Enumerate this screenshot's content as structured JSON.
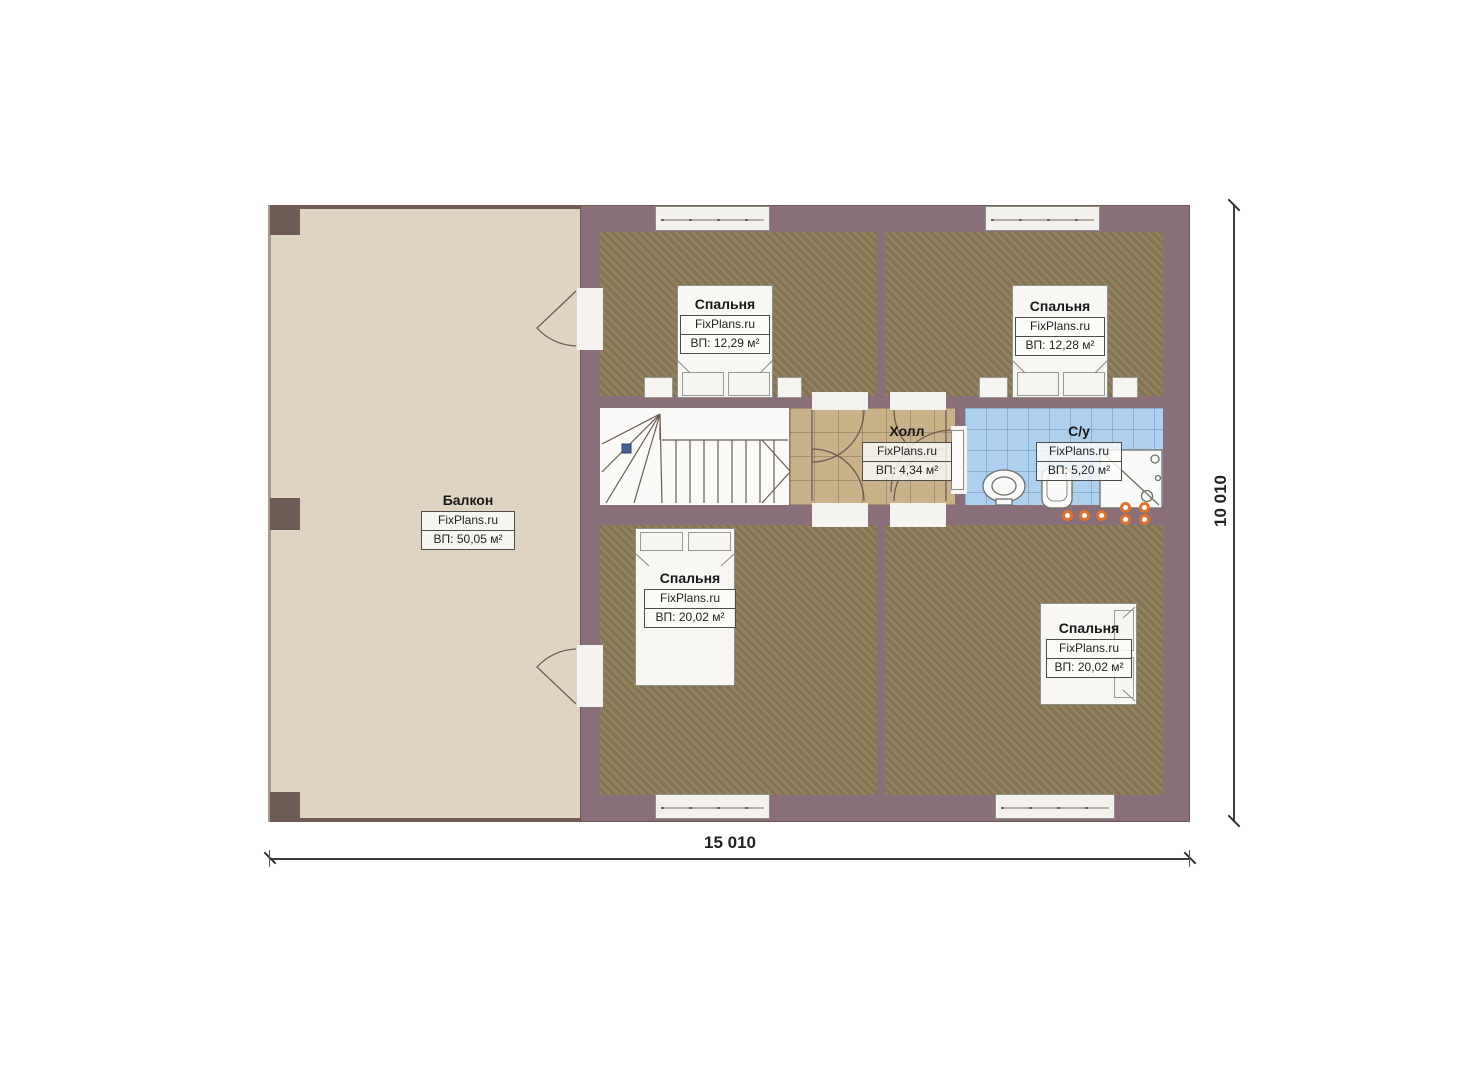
{
  "plan": {
    "watermark": "FixPlans.ru",
    "dimensions": {
      "width": "15 010",
      "height": "10 010"
    },
    "rooms": {
      "balcony": {
        "name": "Балкон",
        "area": "ВП: 50,05 м²"
      },
      "bedroom_tl": {
        "name": "Спальня",
        "area": "ВП: 12,29 м²"
      },
      "bedroom_tr": {
        "name": "Спальня",
        "area": "ВП: 12,28 м²"
      },
      "hall": {
        "name": "Холл",
        "area": "ВП: 4,34 м²"
      },
      "bathroom": {
        "name": "С/у",
        "area": "ВП: 5,20 м²"
      },
      "bedroom_bl": {
        "name": "Спальня",
        "area": "ВП: 20,02 м²"
      },
      "bedroom_br": {
        "name": "Спальня",
        "area": "ВП: 20,02 м²"
      }
    },
    "colors": {
      "wall": "#8a6f7b",
      "balcony_floor": "#dfd4c1",
      "carpet": "#8c7a56",
      "hall_tile": "#c9b189",
      "bath_tile": "#aed0ef",
      "accent_orange": "#e0722a"
    }
  }
}
